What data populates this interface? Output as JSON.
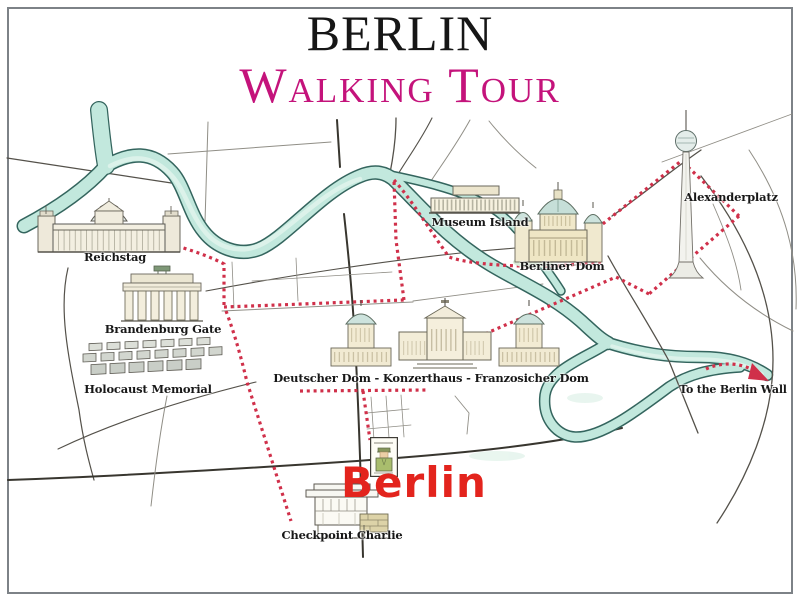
{
  "title": {
    "line1": "BERLIN",
    "line2": "Walking Tour"
  },
  "labels": {
    "reichstag": "Reichstag",
    "brandenburg_gate": "Brandenburg Gate",
    "holocaust_memorial": "Holocaust Memorial",
    "museum_island": "Museum Island",
    "berliner_dom": "Berliner Dom",
    "alexanderplatz": "Alexanderplatz",
    "gendarmenmarkt": "Deutscher Dom - Konzerthaus - Franzosicher Dom",
    "checkpoint_charlie": "Checkpoint Charlie",
    "to_berlin_wall": "To the Berlin Wall",
    "berlin_stamp": "Berlin"
  },
  "colors": {
    "title_accent": "#c4137b",
    "route": "#d0304a",
    "river_fill": "#c2e8dd",
    "river_edge": "#34655e",
    "stamp_red": "#e3241d",
    "label_ink": "#181818",
    "road": "#54514a",
    "road_light": "#908e86",
    "road_dark": "#38362f"
  }
}
